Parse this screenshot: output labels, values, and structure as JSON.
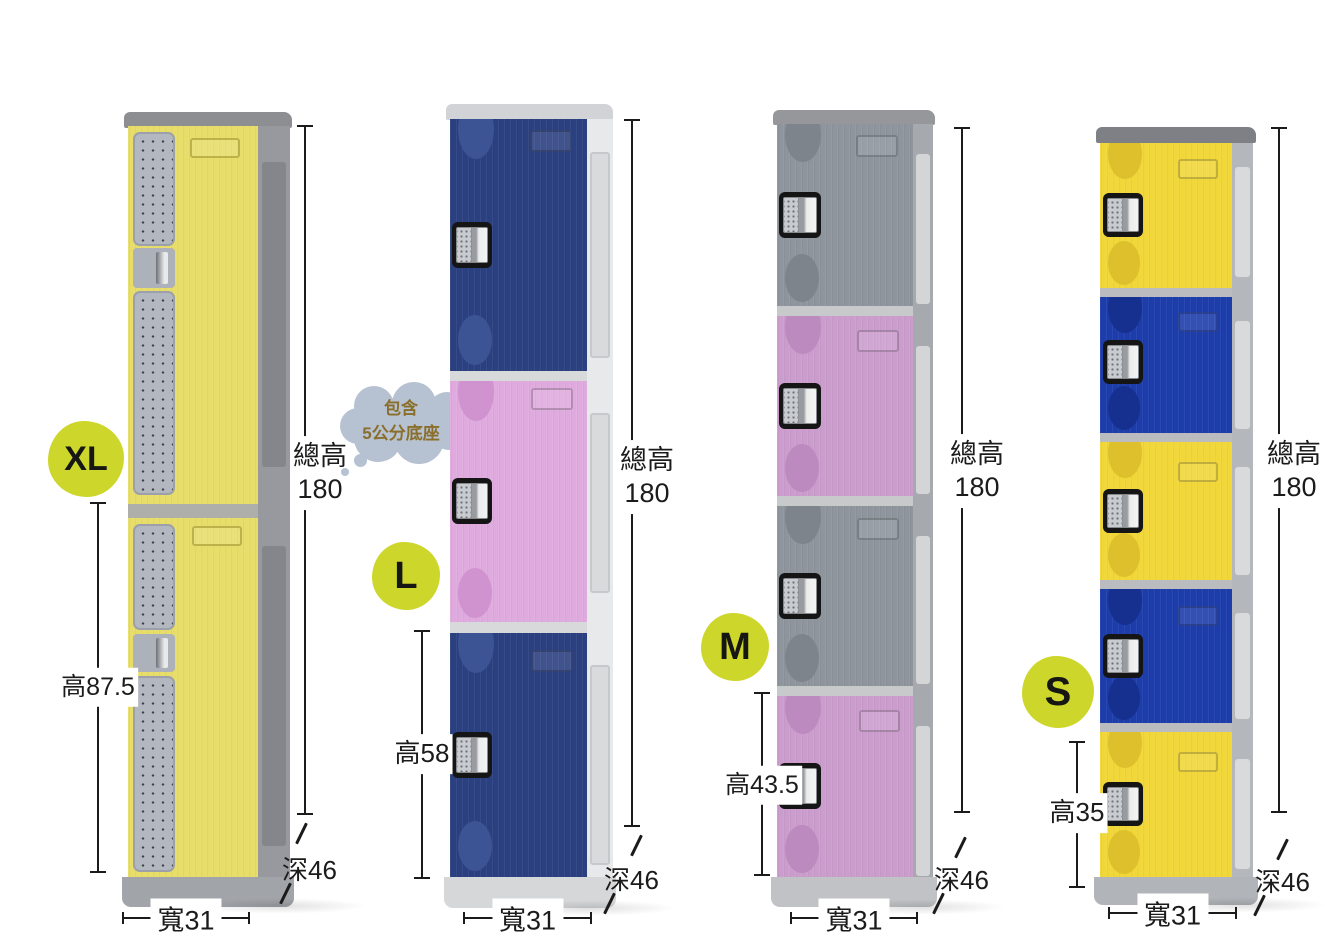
{
  "badge_color": "#cdd62b",
  "bubble": {
    "line1": "包含",
    "line2": "5公分底座"
  },
  "lockers": [
    {
      "badge": "XL",
      "door_count": 2,
      "door_colors": [
        "#e7dd68"
      ],
      "annotations": {
        "door_height": "高87.5",
        "total_height_label": "總高",
        "total_height_value": "180",
        "depth": "深46",
        "width": "寬31"
      }
    },
    {
      "badge": "L",
      "door_count": 3,
      "door_colors": [
        "#2b4080",
        "#dfaade",
        "#2b4080"
      ],
      "annotations": {
        "door_height": "高58",
        "total_height_label": "總高",
        "total_height_value": "180",
        "depth": "深46",
        "width": "寬31"
      }
    },
    {
      "badge": "M",
      "door_count": 4,
      "door_colors": [
        "#8e949c",
        "#cb9dcd",
        "#8e949c",
        "#cb9dcd"
      ],
      "annotations": {
        "door_height": "高43.5",
        "total_height_label": "總高",
        "total_height_value": "180",
        "depth": "深46",
        "width": "寬31"
      }
    },
    {
      "badge": "S",
      "door_count": 5,
      "door_colors": [
        "#f1d737",
        "#1d3dab",
        "#f1d737",
        "#1d3dab",
        "#f1d737"
      ],
      "annotations": {
        "door_height": "高35",
        "total_height_label": "總高",
        "total_height_value": "180",
        "depth": "深46",
        "width": "寬31"
      }
    }
  ]
}
